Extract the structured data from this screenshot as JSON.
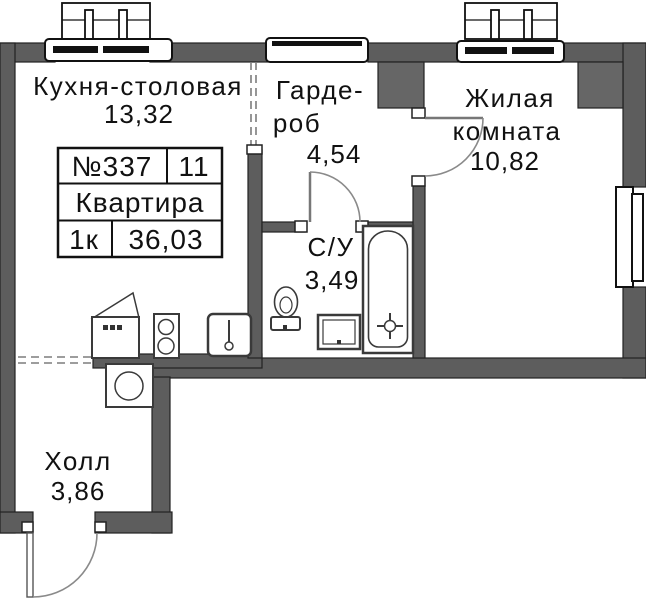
{
  "plan": {
    "title": "apartment-floor-plan",
    "info_table": {
      "apartment_number": "№337",
      "section_number": "11",
      "type_label": "Квартира",
      "rooms_count": "1к",
      "total_area": "36,03"
    },
    "rooms": {
      "kitchen": {
        "name": "Кухня-столовая",
        "area": "13,32"
      },
      "wardrobe": {
        "name_lines": [
          "Гарде-",
          "роб"
        ],
        "area": "4,54"
      },
      "living": {
        "name_lines": [
          "Жилая",
          "комната"
        ],
        "area": "10,82"
      },
      "bathroom": {
        "name": "С/У",
        "area": "3,49"
      },
      "hall": {
        "name": "Холл",
        "area": "3,86"
      }
    },
    "fixtures": [
      "fridge",
      "stove",
      "kitchen-sink",
      "washing-machine",
      "toilet",
      "bathroom-sink",
      "bathtub"
    ],
    "openings": [
      "entrance-door",
      "living-room-door",
      "bathroom-door",
      "kitchen-window",
      "living-room-window",
      "side-window"
    ],
    "colors": {
      "wall": "#5d5d5d",
      "outline": "#111111",
      "text": "#111111",
      "door_arc": "#8a8a8a",
      "background": "#ffffff"
    }
  }
}
